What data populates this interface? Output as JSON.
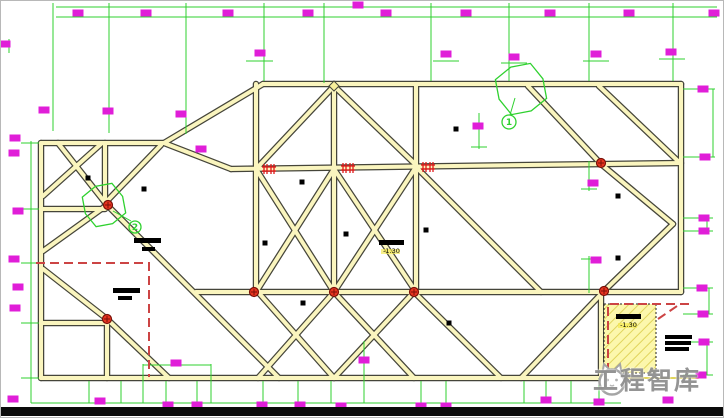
{
  "meta": {
    "drawing_type": "structural-beam-plan"
  },
  "colors": {
    "background": "#FFFFFF",
    "beam_fill": "#FAF5BE",
    "beam_outline": "#45453A",
    "dim_green": "#2FD12F",
    "magenta": "#E01ED8",
    "node_red": "#E83520",
    "node_red_dark": "#7A1008",
    "hash_red": "#E01818",
    "dashed_red": "#CC4444",
    "hatch_fill": "#FCF7AC",
    "hatch_line": "#E0D45C",
    "annotation_black": "#000000",
    "bottom_bar": "#0A0A0A",
    "watermark_gray": "#8F8F8F",
    "elev_highlight": "#F4E84A"
  },
  "watermark": {
    "text": "工程智库",
    "logo": "cat-logo"
  },
  "annotations": {
    "elevations": [
      {
        "x": 378,
        "y": 239,
        "w": 25,
        "h": 5,
        "label": "-1.30"
      },
      {
        "x": 615,
        "y": 313,
        "w": 25,
        "h": 5,
        "label": "-1.30"
      }
    ],
    "detail_markers": [
      {
        "cx": 508,
        "cy": 121,
        "r": 7,
        "label": "1"
      },
      {
        "cx": 134,
        "cy": 226,
        "r": 6,
        "label": "2"
      }
    ],
    "clouds": [
      {
        "cx": 520,
        "cy": 88,
        "r": 26
      },
      {
        "cx": 103,
        "cy": 204,
        "r": 22
      }
    ]
  },
  "geometry": {
    "beams": [
      [
        40,
        142,
        163,
        142
      ],
      [
        163,
        142,
        262,
        83
      ],
      [
        262,
        83,
        680,
        83
      ],
      [
        680,
        83,
        680,
        291
      ],
      [
        600,
        291,
        600,
        376
      ],
      [
        40,
        142,
        40,
        377
      ],
      [
        40,
        377,
        600,
        377
      ],
      [
        230,
        168,
        680,
        162
      ],
      [
        195,
        291,
        680,
        291
      ],
      [
        40,
        208,
        104,
        208
      ],
      [
        40,
        322,
        104,
        322
      ],
      [
        255,
        83,
        255,
        291
      ],
      [
        333,
        85,
        333,
        291
      ],
      [
        415,
        83,
        415,
        291
      ],
      [
        104,
        142,
        104,
        204
      ],
      [
        106,
        318,
        106,
        377
      ],
      [
        57,
        142,
        106,
        204
      ],
      [
        100,
        143,
        42,
        195
      ],
      [
        160,
        144,
        106,
        200
      ],
      [
        163,
        142,
        230,
        168
      ],
      [
        106,
        204,
        42,
        250
      ],
      [
        42,
        268,
        106,
        318
      ],
      [
        106,
        318,
        168,
        377
      ],
      [
        106,
        204,
        278,
        377
      ],
      [
        333,
        85,
        255,
        168
      ],
      [
        333,
        85,
        415,
        164
      ],
      [
        255,
        168,
        333,
        291
      ],
      [
        415,
        166,
        333,
        291
      ],
      [
        333,
        168,
        415,
        291
      ],
      [
        333,
        168,
        255,
        291
      ],
      [
        257,
        291,
        333,
        377
      ],
      [
        333,
        291,
        257,
        377
      ],
      [
        333,
        291,
        413,
        377
      ],
      [
        413,
        291,
        333,
        377
      ],
      [
        413,
        291,
        500,
        377
      ],
      [
        415,
        166,
        540,
        291
      ],
      [
        603,
        290,
        520,
        377
      ],
      [
        527,
        85,
        600,
        163
      ],
      [
        598,
        85,
        678,
        161
      ],
      [
        600,
        163,
        672,
        223
      ],
      [
        672,
        223,
        603,
        290
      ]
    ],
    "thin_yellow": [
      [
        600,
        377,
        697,
        377
      ]
    ],
    "dim_lines": [
      [
        55,
        6,
        716,
        6
      ],
      [
        55,
        16,
        716,
        16
      ],
      [
        52,
        2,
        52,
        130
      ],
      [
        108,
        2,
        108,
        132
      ],
      [
        185,
        2,
        185,
        133
      ],
      [
        263,
        2,
        263,
        80
      ],
      [
        323,
        2,
        323,
        82
      ],
      [
        430,
        2,
        430,
        80
      ],
      [
        508,
        2,
        508,
        80
      ],
      [
        588,
        2,
        588,
        80
      ],
      [
        672,
        2,
        672,
        80
      ],
      [
        245,
        60,
        272,
        60
      ],
      [
        432,
        60,
        458,
        60
      ],
      [
        500,
        62,
        526,
        62
      ],
      [
        582,
        60,
        608,
        60
      ],
      [
        658,
        58,
        684,
        58
      ],
      [
        30,
        140,
        30,
        402
      ],
      [
        20,
        142,
        38,
        142
      ],
      [
        20,
        208,
        38,
        208
      ],
      [
        20,
        262,
        38,
        262
      ],
      [
        20,
        322,
        38,
        322
      ],
      [
        20,
        377,
        38,
        377
      ],
      [
        30,
        402,
        46,
        402
      ],
      [
        8,
        38,
        8,
        52
      ],
      [
        682,
        88,
        714,
        88
      ],
      [
        682,
        156,
        714,
        156
      ],
      [
        712,
        88,
        712,
        156
      ],
      [
        682,
        217,
        712,
        217
      ],
      [
        682,
        230,
        712,
        230
      ],
      [
        706,
        217,
        706,
        230
      ],
      [
        682,
        287,
        712,
        287
      ],
      [
        682,
        313,
        712,
        313
      ],
      [
        708,
        287,
        708,
        313
      ],
      [
        682,
        341,
        712,
        341
      ],
      [
        682,
        374,
        712,
        374
      ],
      [
        706,
        341,
        706,
        374
      ],
      [
        45,
        402,
        620,
        402
      ],
      [
        88,
        380,
        88,
        402
      ],
      [
        120,
        380,
        120,
        402
      ],
      [
        142,
        363,
        142,
        402
      ],
      [
        165,
        380,
        165,
        402
      ],
      [
        196,
        380,
        196,
        402
      ],
      [
        210,
        363,
        210,
        402
      ],
      [
        142,
        364,
        210,
        364
      ],
      [
        262,
        380,
        262,
        402
      ],
      [
        297,
        380,
        297,
        402
      ],
      [
        330,
        380,
        330,
        402
      ],
      [
        363,
        340,
        363,
        402
      ],
      [
        420,
        380,
        420,
        402
      ],
      [
        445,
        380,
        445,
        402
      ],
      [
        523,
        380,
        523,
        402
      ],
      [
        545,
        380,
        545,
        402
      ],
      [
        570,
        380,
        570,
        402
      ],
      [
        598,
        377,
        598,
        402
      ],
      [
        478,
        112,
        478,
        148
      ],
      [
        470,
        146,
        486,
        146
      ],
      [
        588,
        160,
        588,
        190
      ],
      [
        580,
        188,
        596,
        188
      ],
      [
        588,
        255,
        588,
        292
      ],
      [
        580,
        258,
        596,
        258
      ],
      [
        509,
        114,
        514,
        97
      ],
      [
        130,
        220,
        112,
        210
      ]
    ],
    "magenta_blocks": [
      [
        77,
        12
      ],
      [
        145,
        12
      ],
      [
        227,
        12
      ],
      [
        307,
        12
      ],
      [
        357,
        4
      ],
      [
        385,
        12
      ],
      [
        465,
        12
      ],
      [
        549,
        12
      ],
      [
        628,
        12
      ],
      [
        713,
        12
      ],
      [
        259,
        52
      ],
      [
        445,
        53
      ],
      [
        513,
        56
      ],
      [
        595,
        53
      ],
      [
        670,
        51
      ],
      [
        43,
        109
      ],
      [
        107,
        110
      ],
      [
        180,
        113
      ],
      [
        200,
        148
      ],
      [
        4,
        43
      ],
      [
        14,
        137
      ],
      [
        13,
        152
      ],
      [
        17,
        210
      ],
      [
        13,
        258
      ],
      [
        17,
        286
      ],
      [
        14,
        307
      ],
      [
        12,
        398
      ],
      [
        702,
        88
      ],
      [
        704,
        156
      ],
      [
        703,
        217
      ],
      [
        703,
        230
      ],
      [
        701,
        287
      ],
      [
        702,
        313
      ],
      [
        703,
        341
      ],
      [
        700,
        374
      ],
      [
        99,
        400
      ],
      [
        167,
        404
      ],
      [
        196,
        404
      ],
      [
        261,
        404
      ],
      [
        299,
        404
      ],
      [
        340,
        405
      ],
      [
        420,
        405
      ],
      [
        445,
        405
      ],
      [
        545,
        399
      ],
      [
        598,
        401
      ],
      [
        667,
        399
      ],
      [
        477,
        125
      ],
      [
        592,
        182
      ],
      [
        595,
        259
      ],
      [
        363,
        359
      ],
      [
        175,
        362
      ]
    ],
    "black_squares": [
      [
        87,
        177
      ],
      [
        143,
        188
      ],
      [
        264,
        242
      ],
      [
        301,
        181
      ],
      [
        345,
        233
      ],
      [
        425,
        229
      ],
      [
        455,
        128
      ],
      [
        617,
        195
      ],
      [
        617,
        257
      ],
      [
        302,
        302
      ],
      [
        448,
        322
      ]
    ],
    "black_bars": [
      [
        133,
        237,
        27,
        5
      ],
      [
        141,
        246,
        13,
        4
      ],
      [
        112,
        287,
        27,
        5
      ],
      [
        117,
        295,
        14,
        4
      ],
      [
        664,
        334,
        27,
        4
      ],
      [
        664,
        340,
        26,
        4
      ],
      [
        664,
        346,
        24,
        4
      ]
    ],
    "red_nodes": [
      [
        107,
        204
      ],
      [
        106,
        318
      ],
      [
        253,
        291
      ],
      [
        333,
        291
      ],
      [
        413,
        291
      ],
      [
        600,
        162
      ],
      [
        603,
        290
      ]
    ],
    "hash_markers": [
      [
        268,
        168
      ],
      [
        347,
        167
      ],
      [
        427,
        166
      ]
    ],
    "dashed_red": [
      [
        [
          35,
          262
        ],
        [
          148,
          262
        ],
        [
          148,
          376
        ]
      ],
      [
        [
          688,
          303
        ],
        [
          607,
          303
        ],
        [
          607,
          372
        ]
      ],
      [
        [
          657,
          318
        ],
        [
          679,
          303
        ]
      ]
    ],
    "hatch_region": {
      "x": 603,
      "y": 303,
      "w": 52,
      "h": 69
    },
    "apex_diamond": {
      "cx": 333,
      "cy": 85,
      "r": 5
    },
    "bottom_bar": {
      "x": 0,
      "y": 406,
      "w": 724,
      "h": 9
    }
  }
}
